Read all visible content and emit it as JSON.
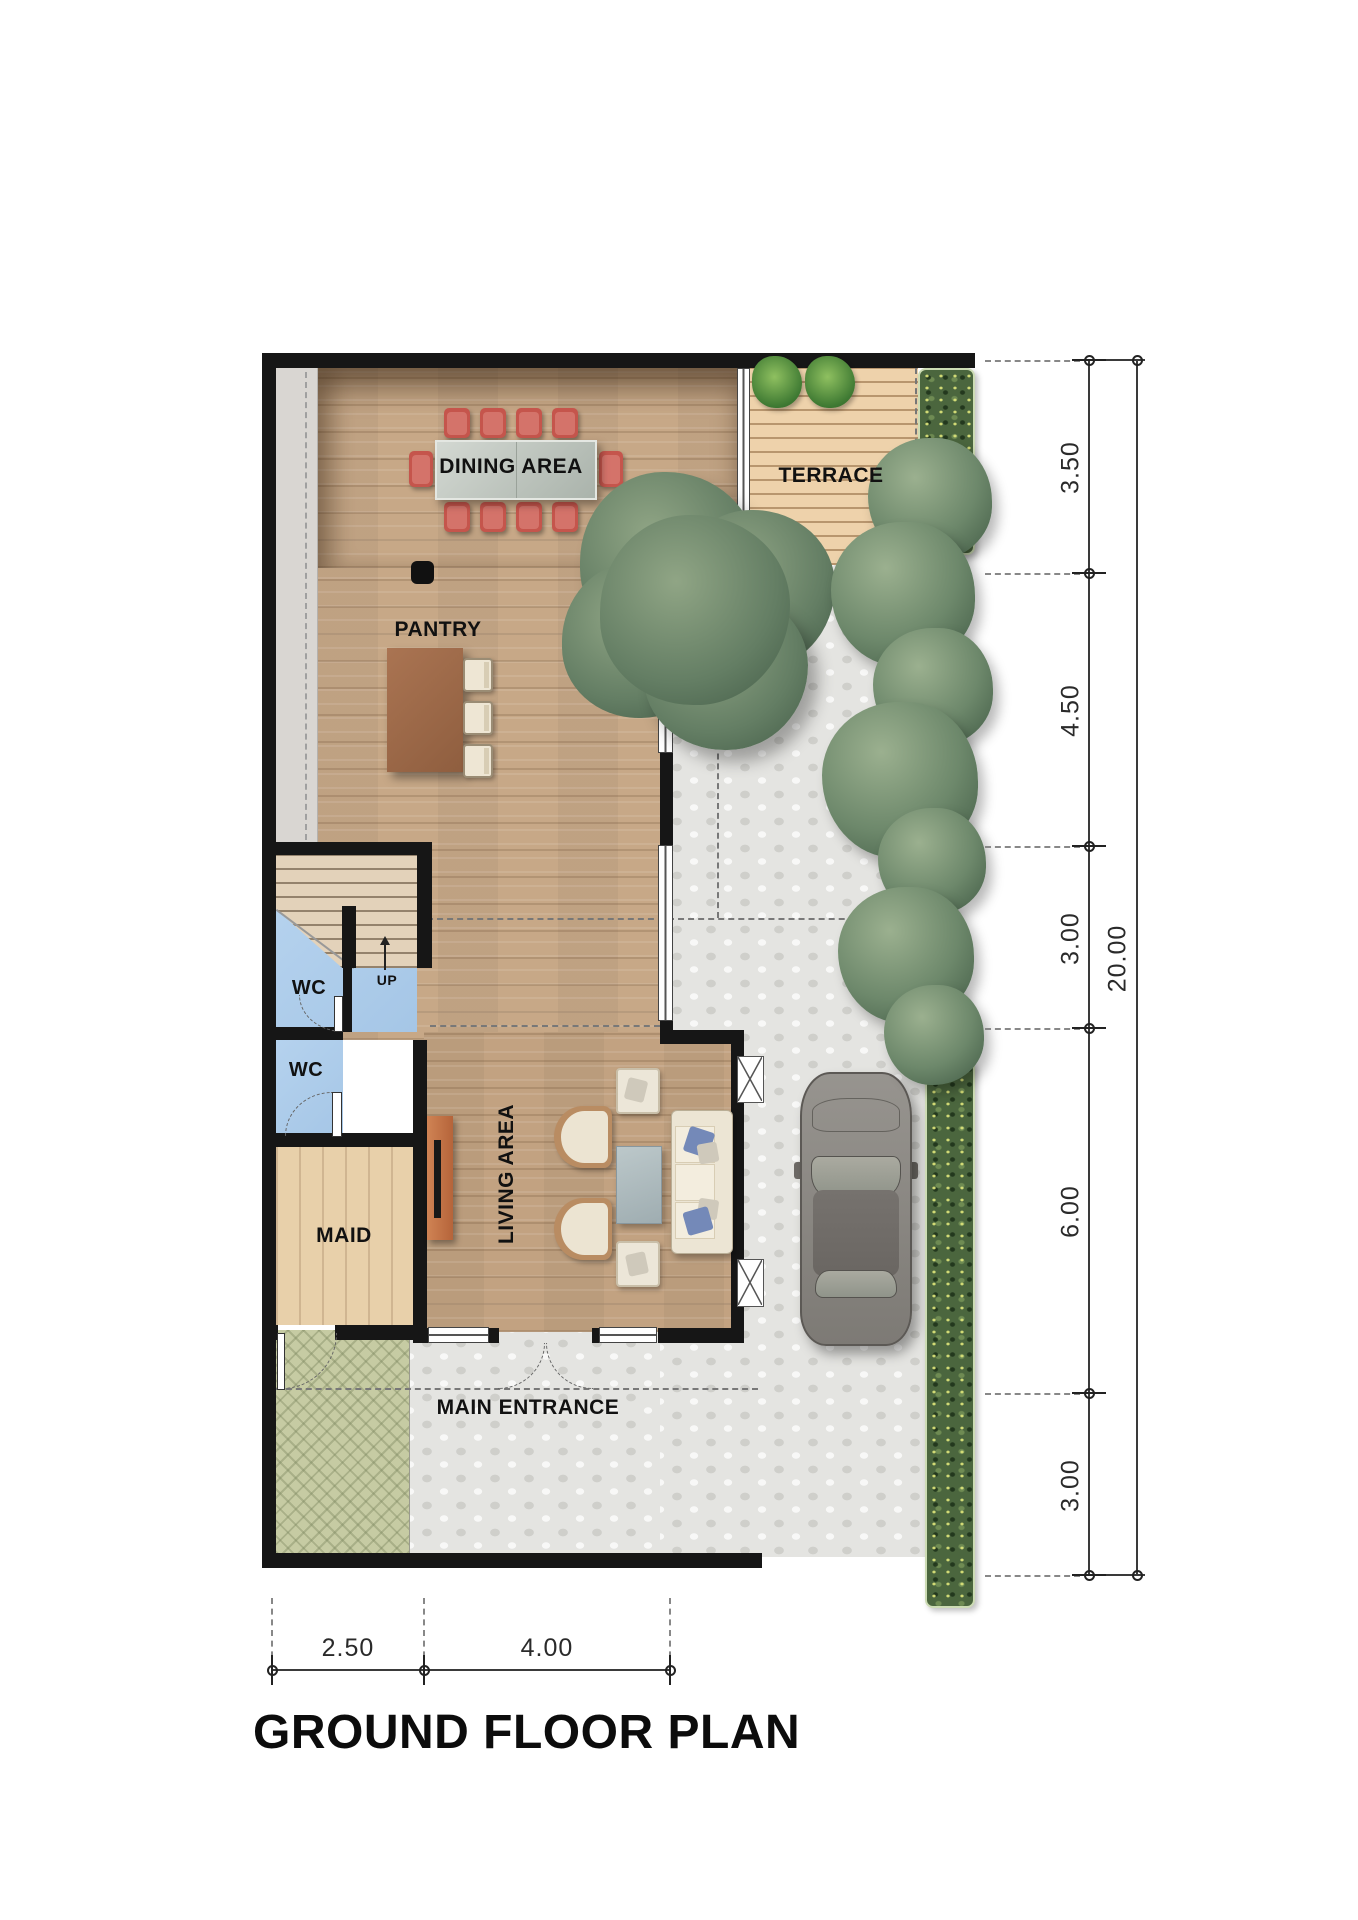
{
  "title": "GROUND FLOOR PLAN",
  "rooms": {
    "dining": "DINING AREA",
    "terrace": "TERRACE",
    "pantry": "PANTRY",
    "wc_upper": "WC",
    "wc_lower": "WC",
    "maid": "MAID",
    "living": "LIVING AREA",
    "main_entrance": "MAIN ENTRANCE"
  },
  "stairs": {
    "direction_label": "UP"
  },
  "dimensions": {
    "right_segments": [
      {
        "value": "3.50"
      },
      {
        "value": "4.50"
      },
      {
        "value": "3.00"
      },
      {
        "value": "6.00"
      },
      {
        "value": "3.00"
      }
    ],
    "right_total": {
      "value": "20.00"
    },
    "bottom_segments": [
      {
        "value": "2.50"
      },
      {
        "value": "4.00"
      }
    ]
  },
  "palette": {
    "wall": "#161616",
    "wood_floor": "#c7a887",
    "maid_floor": "#e8d0aa",
    "terrace_deck": "#eed2ab",
    "wc_floor": "#aecce9",
    "stone_paving": "#e4e4e1",
    "carport_paving": "#c6cba3",
    "dining_chair_red": "#c5554c",
    "pantry_counter": "#9c6845",
    "tv_console": "#c27048",
    "sofa_cream": "#ece5d4",
    "hedge_green": "#4b663e",
    "tree_green": "#647e64",
    "car_gray": "#8a8783"
  },
  "objects": [
    "dining-table",
    "dining-chairs-x10",
    "pantry-counter",
    "pantry-stools-x3",
    "structural-column",
    "staircase-up",
    "tv-console",
    "armchairs-x2",
    "side-chairs-x2",
    "coffee-table",
    "sofa",
    "main-entrance-double-door",
    "wc-doors-x2",
    "carport-door",
    "car",
    "big-tree",
    "shrub-row",
    "flower-hedges",
    "terrace-plants-x2"
  ]
}
